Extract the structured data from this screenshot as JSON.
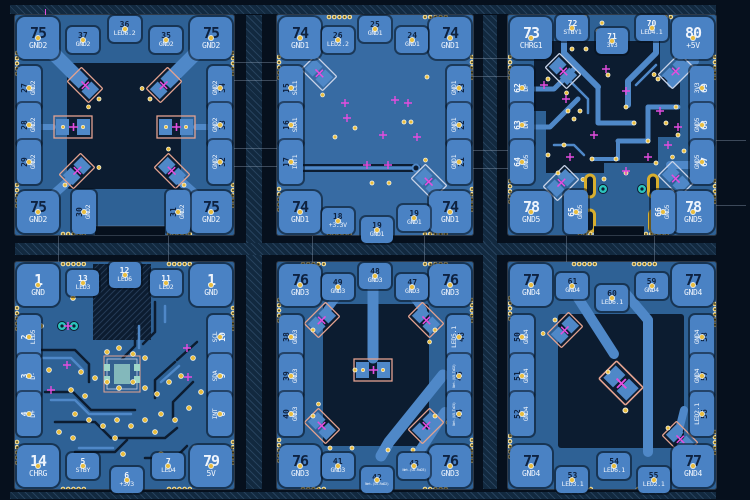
{
  "app": {
    "view_label": "PCB copper layout, six panelized modules"
  },
  "colors": {
    "background": "#06101d",
    "rail_band": "#12293f",
    "board_dark": "#0c1c30",
    "copper_pour": "#2e6195",
    "copper_pour_light": "#376ba3",
    "copper_trace": "#4f88c8",
    "pad_fill": "#4a82c4",
    "pad_number_dark": "#0e2240",
    "text_light": "#eef4fc",
    "via_gold": "#e9bd3e",
    "via_ring": "#f6f6ec",
    "magenta_marker": "#e54ddf",
    "teal_hole": "#2cc5bd",
    "courtyard_salmon": "#e4a28f",
    "courtyard_silver": "#c9d3e8",
    "gold_pad": "#d8ae2e",
    "outline_gray": "#8fa3ba",
    "ic_pad_teal": "#9fd6c9"
  },
  "boards": [
    {
      "name": "board-1",
      "number_style": "dark",
      "corners": [
        {
          "num": "75",
          "net": "GND2"
        },
        {
          "num": "75",
          "net": "GND2"
        },
        {
          "num": "75",
          "net": "GND2"
        },
        {
          "num": "75",
          "net": "GND2"
        }
      ],
      "top": [
        {
          "num": "37",
          "net": "GND2"
        },
        {
          "num": "36",
          "net": "LED6.2"
        },
        {
          "num": "35",
          "net": "GND2"
        }
      ],
      "left": [
        {
          "num": "27",
          "net": "GND2"
        },
        {
          "num": "28",
          "net": "GND2"
        },
        {
          "num": "29",
          "net": "GND2"
        }
      ],
      "right": [
        {
          "num": "34",
          "net": "GND2"
        },
        {
          "num": "33",
          "net": "GND2"
        },
        {
          "num": "32",
          "net": "GND2"
        }
      ],
      "bottom": [
        {
          "num": "30",
          "net": "GND2"
        },
        {
          "num": "31",
          "net": "GND2"
        }
      ]
    },
    {
      "name": "board-2",
      "number_style": "dark",
      "corners": [
        {
          "num": "74",
          "net": "GND1"
        },
        {
          "num": "74",
          "net": "GND1"
        },
        {
          "num": "74",
          "net": "GND1"
        },
        {
          "num": "74",
          "net": "GND1"
        }
      ],
      "top": [
        {
          "num": "26",
          "net": "LED2.2"
        },
        {
          "num": "25",
          "net": "GND1"
        },
        {
          "num": "24",
          "net": "GND1"
        }
      ],
      "left": [
        {
          "num": "15",
          "net": "SCL1"
        },
        {
          "num": "16",
          "net": "SDA1"
        },
        {
          "num": "17",
          "net": "INT1"
        }
      ],
      "right": [
        {
          "num": "23",
          "net": "GND1"
        },
        {
          "num": "22",
          "net": "GND1"
        },
        {
          "num": "21",
          "net": "GND1"
        }
      ],
      "bottom": [
        {
          "num": "18",
          "net": "+3.3V"
        },
        {
          "num": "19",
          "net": "GND1"
        },
        {
          "num": "19",
          "net": "GND1"
        }
      ]
    },
    {
      "name": "board-3",
      "number_style": "light",
      "corners": [
        {
          "num": "73",
          "net": "CHRG1"
        },
        {
          "num": "80",
          "net": "+5V"
        },
        {
          "num": "78",
          "net": "GND5"
        },
        {
          "num": "78",
          "net": "GND5"
        }
      ],
      "top": [
        {
          "num": "72",
          "net": "STBY1"
        },
        {
          "num": "71",
          "net": "3V3"
        },
        {
          "num": "70",
          "net": "LED4.1"
        }
      ],
      "left": [
        {
          "num": "62",
          "net": "DP"
        },
        {
          "num": "63",
          "net": "DM"
        },
        {
          "num": "64",
          "net": "GND5"
        }
      ],
      "right": [
        {
          "num": "69",
          "net": "3V3"
        },
        {
          "num": "68",
          "net": "GND5"
        },
        {
          "num": "67",
          "net": "GND5"
        }
      ],
      "bottom": [
        {
          "num": "65",
          "net": "GND5"
        },
        {
          "num": "66",
          "net": "GND5"
        }
      ]
    },
    {
      "name": "board-4",
      "number_style": "light",
      "corners": [
        {
          "num": "1",
          "net": "GND"
        },
        {
          "num": "1",
          "net": "GND"
        },
        {
          "num": "14",
          "net": "CHRG"
        },
        {
          "num": "79",
          "net": "5V"
        }
      ],
      "top": [
        {
          "num": "13",
          "net": "LED3"
        },
        {
          "num": "12",
          "net": "LED6"
        },
        {
          "num": "11",
          "net": "LED2"
        }
      ],
      "left": [
        {
          "num": "2",
          "net": "LED5"
        },
        {
          "num": "3",
          "net": "D-"
        },
        {
          "num": "4",
          "net": "D+"
        }
      ],
      "right": [
        {
          "num": "10",
          "net": "SCL"
        },
        {
          "num": "9",
          "net": "SDA"
        },
        {
          "num": "8",
          "net": "INT"
        }
      ],
      "bottom": [
        {
          "num": "5",
          "net": "STBY"
        },
        {
          "num": "6",
          "net": "+3V3"
        },
        {
          "num": "7",
          "net": "LED4"
        }
      ]
    },
    {
      "name": "board-5",
      "number_style": "dark",
      "corners": [
        {
          "num": "76",
          "net": "GND3"
        },
        {
          "num": "76",
          "net": "GND3"
        },
        {
          "num": "76",
          "net": "GND3"
        },
        {
          "num": "76",
          "net": "GND3"
        }
      ],
      "top": [
        {
          "num": "49",
          "net": "GND3"
        },
        {
          "num": "48",
          "net": "GND3"
        },
        {
          "num": "47",
          "net": "GND3"
        }
      ],
      "left": [
        {
          "num": "38",
          "net": "GND3"
        },
        {
          "num": "39",
          "net": "GND3"
        },
        {
          "num": "40",
          "net": "GND3"
        }
      ],
      "right": [
        {
          "num": "46",
          "net": "LED5.1"
        },
        {
          "num": "45",
          "net": "Net-(U5-TxD2)"
        },
        {
          "num": "44",
          "net": "Net-(U5-TxD3)"
        }
      ],
      "bottom": [
        {
          "num": "41",
          "net": "GND3"
        },
        {
          "num": "42",
          "net": "Net-(U5-RxD2)"
        },
        {
          "num": "43",
          "net": "Net-(U5-RxD3)"
        }
      ]
    },
    {
      "name": "board-6",
      "number_style": "dark",
      "corners": [
        {
          "num": "77",
          "net": "GND4"
        },
        {
          "num": "77",
          "net": "GND4"
        },
        {
          "num": "77",
          "net": "GND4"
        },
        {
          "num": "77",
          "net": "GND4"
        }
      ],
      "top": [
        {
          "num": "61",
          "net": "GND4"
        },
        {
          "num": "60",
          "net": "LED6.1"
        },
        {
          "num": "59",
          "net": "GND4"
        }
      ],
      "left": [
        {
          "num": "50",
          "net": "GND4"
        },
        {
          "num": "51",
          "net": "GND4"
        },
        {
          "num": "52",
          "net": "GND4"
        }
      ],
      "right": [
        {
          "num": "58",
          "net": "GND4"
        },
        {
          "num": "57",
          "net": "GND4"
        },
        {
          "num": "56",
          "net": "LED2.1"
        }
      ],
      "bottom": [
        {
          "num": "53",
          "net": "LED3.1"
        },
        {
          "num": "54",
          "net": "LED6.1"
        },
        {
          "num": "55",
          "net": "LED2.1"
        }
      ]
    }
  ]
}
